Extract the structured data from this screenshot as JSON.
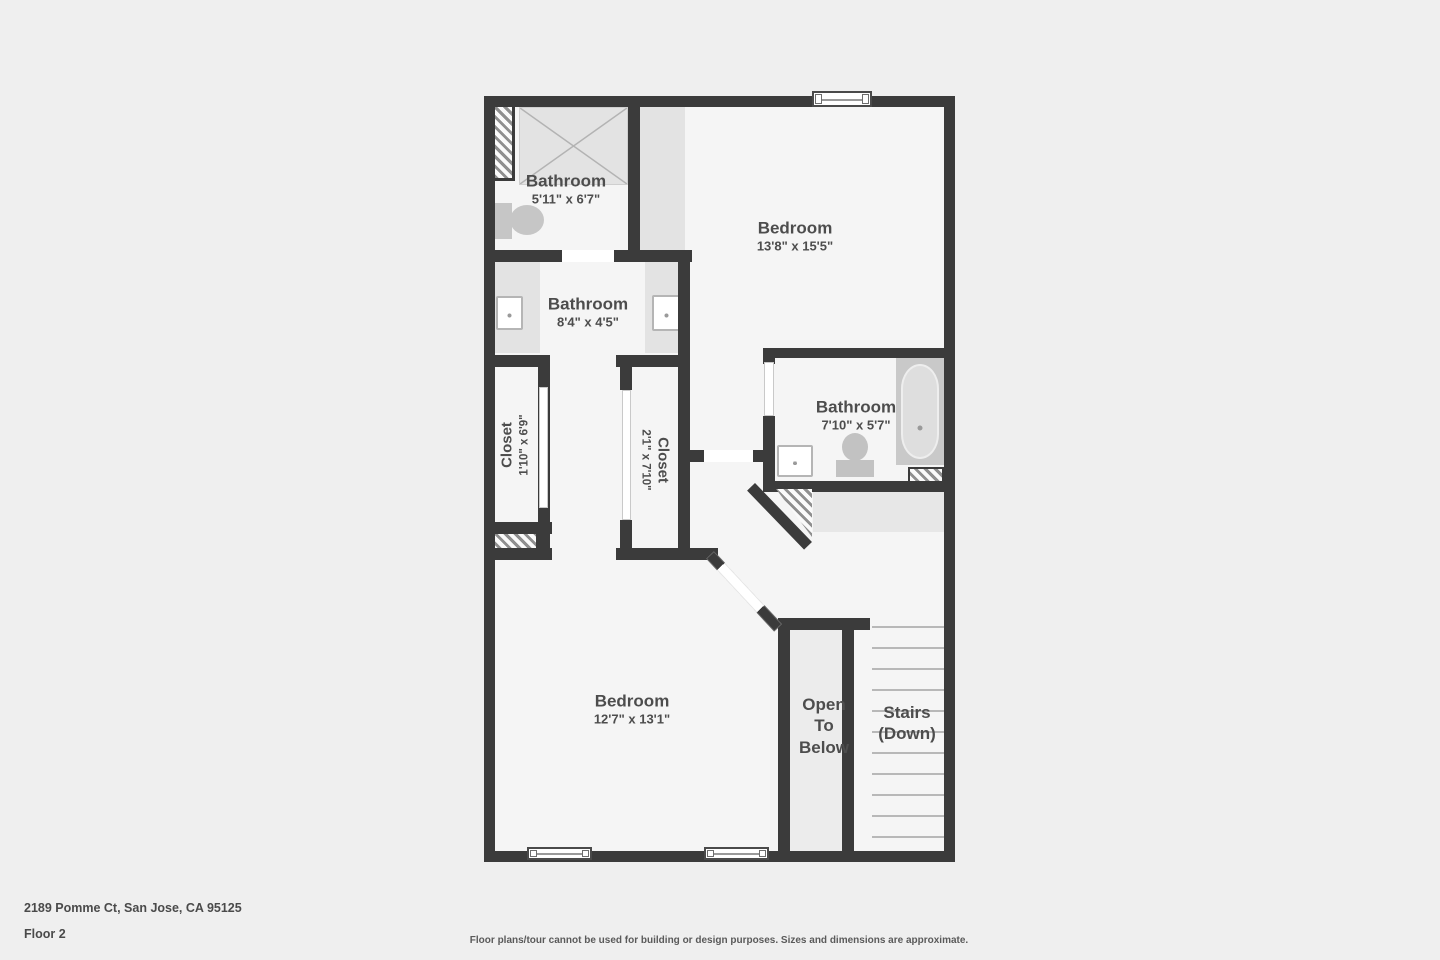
{
  "plan": {
    "rooms": [
      {
        "name": "Bathroom",
        "dims": "5'11\" x 6'7\""
      },
      {
        "name": "Bathroom",
        "dims": "8'4\" x 4'5\""
      },
      {
        "name": "Bedroom",
        "dims": "13'8\" x 15'5\""
      },
      {
        "name": "Bathroom",
        "dims": "7'10\" x 5'7\""
      },
      {
        "name": "Closet",
        "dims": "1'10\" x 6'9\""
      },
      {
        "name": "Closet",
        "dims": "2'1\" x 7'10\""
      },
      {
        "name": "Bedroom",
        "dims": "12'7\" x 13'1\""
      },
      {
        "name": "Open To Below",
        "lines": [
          "Open",
          "To",
          "Below"
        ]
      },
      {
        "name": "Stairs (Down)",
        "lines": [
          "Stairs",
          "(Down)"
        ]
      }
    ],
    "stairs": {
      "tread_count": 11
    }
  },
  "footer": {
    "address": "2189 Pomme Ct, San Jose, CA 95125",
    "floor": "Floor 2",
    "disclaimer": "Floor plans/tour cannot be used for building or design purposes. Sizes and dimensions are approximate."
  },
  "colors": {
    "wall": "#3b3b3b",
    "floor": "#f5f5f5",
    "bg": "#efefef",
    "shaded": "#e3e3e3",
    "fixture": "#c6c6c6",
    "text": "#4d4d4d",
    "tread": "#b8b8b8"
  }
}
